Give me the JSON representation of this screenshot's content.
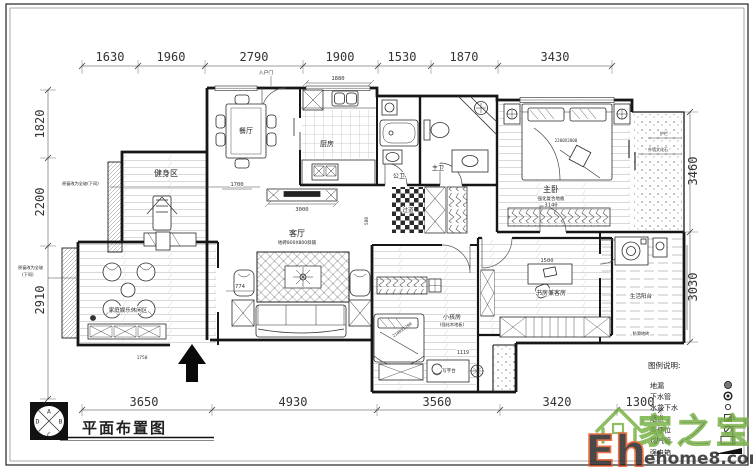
{
  "drawing": {
    "title": "平面布置图",
    "compass": {
      "top": "A",
      "right": "B",
      "bottom": "C",
      "left": "D"
    }
  },
  "dims": {
    "top": [
      "1630",
      "1960",
      "2790",
      "1900",
      "1530",
      "1870",
      "3430"
    ],
    "bottom": [
      "3650",
      "4930",
      "3560",
      "3420",
      "1300"
    ],
    "left": [
      "1820",
      "2200",
      "2910"
    ],
    "right": [
      "3460",
      "3030"
    ]
  },
  "inner_dims": {
    "d1880": "1880",
    "d1700": "1700",
    "d3000": "3000",
    "d774": "774",
    "d3140": "3140",
    "d1500": "1500",
    "d1119": "1119",
    "d580": "580",
    "d1750": "1750",
    "kids_bed": "2100X1200",
    "master_bed": "2200X2000"
  },
  "rooms": {
    "fitness": "健身区",
    "leisure": "家庭娱乐休闲区",
    "dining": "餐厅",
    "kitchen": "厨房",
    "living": "客厅",
    "living_sub": "地砖800X800斜铺",
    "bath_public": "公卫",
    "bath_master": "主卫",
    "hallway": "过道",
    "master": "主卧",
    "master_sub": "强化复合地板",
    "kids": "小孩房",
    "kids_sub": "(强化木地板)",
    "study": "书房兼客房",
    "desk": "写字台",
    "utility_balcony": "生活阳台",
    "utility_sub": "防滑地砖"
  },
  "annotations": {
    "entry_door": "入户门",
    "window_note": "原窗改为全玻(下同)",
    "window_note_l1": "原窗改为全玻",
    "window_note_l2": "(下同)",
    "balcony_rail": "护栏",
    "balcony_stone": "外墙文化石"
  },
  "legend": {
    "title": "图例说明:",
    "items": [
      {
        "label": "地漏"
      },
      {
        "label": "下水管"
      },
      {
        "label": "水盆下水"
      },
      {
        "label": "烟道"
      },
      {
        "label": "座便位"
      },
      {
        "label": "煤气管"
      },
      {
        "label": "强电箱"
      }
    ]
  },
  "watermark": {
    "logo": "Eh",
    "site": "ehome8.com",
    "brand": "家之宝"
  }
}
